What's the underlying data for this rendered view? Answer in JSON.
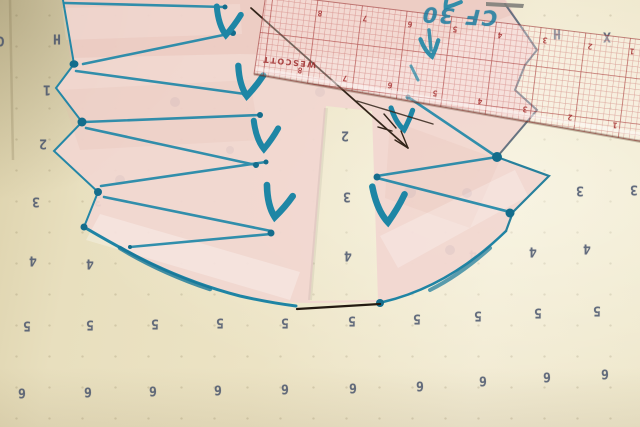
{
  "scene": {
    "colors": {
      "paper": "#ece3c4",
      "tissue_pink": "#f2d8d1",
      "marker_teal": "#1e86a5",
      "ruler_grid_red": "#b23434",
      "pen_brown": "#33251a",
      "printed_digit": "#44506a"
    }
  },
  "paper": {
    "glyphs": [
      {
        "t": "C",
        "x": 1,
        "y": 40
      },
      {
        "t": "H",
        "x": 57,
        "y": 38
      },
      {
        "t": "1",
        "x": 47,
        "y": 89
      },
      {
        "t": "2",
        "x": 43,
        "y": 143
      },
      {
        "t": "3",
        "x": 36,
        "y": 201
      },
      {
        "t": "3",
        "x": 98,
        "y": 200
      },
      {
        "t": "4",
        "x": 33,
        "y": 260
      },
      {
        "t": "4",
        "x": 90,
        "y": 263
      },
      {
        "t": "5",
        "x": 27,
        "y": 325
      },
      {
        "t": "5",
        "x": 90,
        "y": 324
      },
      {
        "t": "5",
        "x": 155,
        "y": 323
      },
      {
        "t": "5",
        "x": 220,
        "y": 322
      },
      {
        "t": "5",
        "x": 285,
        "y": 322
      },
      {
        "t": "5",
        "x": 352,
        "y": 320
      },
      {
        "t": "5",
        "x": 417,
        "y": 318
      },
      {
        "t": "5",
        "x": 478,
        "y": 315
      },
      {
        "t": "5",
        "x": 538,
        "y": 312
      },
      {
        "t": "5",
        "x": 597,
        "y": 310
      },
      {
        "t": "6",
        "x": 22,
        "y": 392
      },
      {
        "t": "6",
        "x": 88,
        "y": 391
      },
      {
        "t": "6",
        "x": 153,
        "y": 390
      },
      {
        "t": "6",
        "x": 218,
        "y": 389
      },
      {
        "t": "6",
        "x": 285,
        "y": 388
      },
      {
        "t": "6",
        "x": 353,
        "y": 387
      },
      {
        "t": "6",
        "x": 420,
        "y": 385
      },
      {
        "t": "6",
        "x": 483,
        "y": 380
      },
      {
        "t": "6",
        "x": 547,
        "y": 376
      },
      {
        "t": "6",
        "x": 605,
        "y": 373
      },
      {
        "t": "2",
        "x": 345,
        "y": 135
      },
      {
        "t": "3",
        "x": 347,
        "y": 196
      },
      {
        "t": "4",
        "x": 348,
        "y": 255
      },
      {
        "t": "3",
        "x": 580,
        "y": 190
      },
      {
        "t": "3",
        "x": 634,
        "y": 189
      },
      {
        "t": "4",
        "x": 473,
        "y": 254
      },
      {
        "t": "4",
        "x": 533,
        "y": 251
      },
      {
        "t": "4",
        "x": 587,
        "y": 248
      },
      {
        "t": "H",
        "x": 557,
        "y": 33
      },
      {
        "t": "X",
        "x": 607,
        "y": 36
      }
    ]
  },
  "ruler": {
    "brand": "WESCOTT",
    "tick_digits": [
      {
        "t": "8",
        "x": 320,
        "y": 13
      },
      {
        "t": "7",
        "x": 365,
        "y": 18
      },
      {
        "t": "6",
        "x": 410,
        "y": 24
      },
      {
        "t": "5",
        "x": 455,
        "y": 29
      },
      {
        "t": "4",
        "x": 500,
        "y": 35
      },
      {
        "t": "3",
        "x": 545,
        "y": 40
      },
      {
        "t": "2",
        "x": 590,
        "y": 46
      },
      {
        "t": "1",
        "x": 632,
        "y": 51
      },
      {
        "t": "8",
        "x": 300,
        "y": 70
      },
      {
        "t": "7",
        "x": 345,
        "y": 78
      },
      {
        "t": "6",
        "x": 390,
        "y": 85
      },
      {
        "t": "5",
        "x": 435,
        "y": 93
      },
      {
        "t": "4",
        "x": 480,
        "y": 101
      },
      {
        "t": "3",
        "x": 525,
        "y": 109
      },
      {
        "t": "2",
        "x": 570,
        "y": 117
      },
      {
        "t": "1",
        "x": 615,
        "y": 125
      }
    ]
  },
  "handwriting": {
    "text": "CF 30"
  }
}
